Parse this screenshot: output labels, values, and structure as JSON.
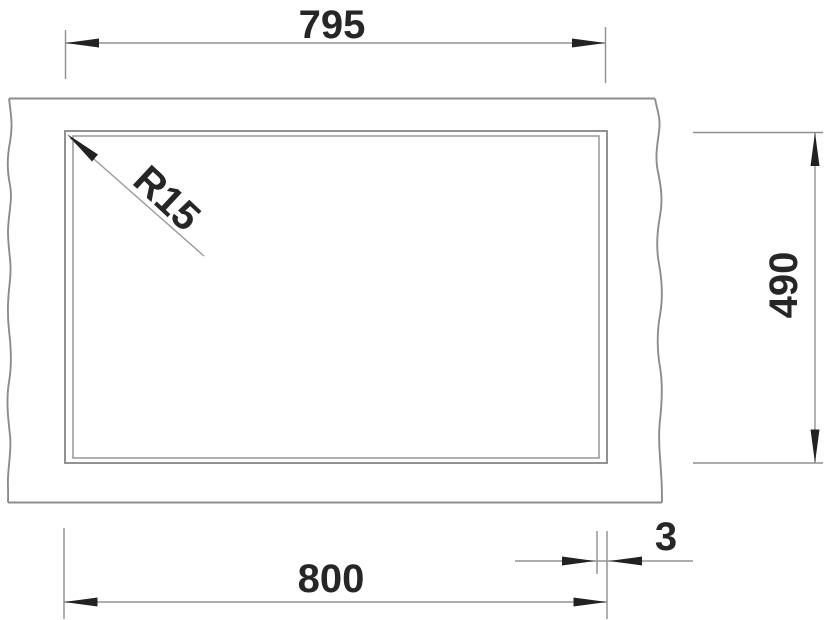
{
  "drawing": {
    "kind": "sink-cutout-technical-drawing",
    "dim_top_width": "795",
    "dim_bottom_width": "800",
    "dim_side_height": "490",
    "dim_edge_gap": "3",
    "corner_radius_label": "R15"
  },
  "colors": {
    "object_line": "#8c8c8c",
    "dimension_line": "#939393",
    "arrow_and_text": "#262626",
    "background": "#ffffff"
  }
}
